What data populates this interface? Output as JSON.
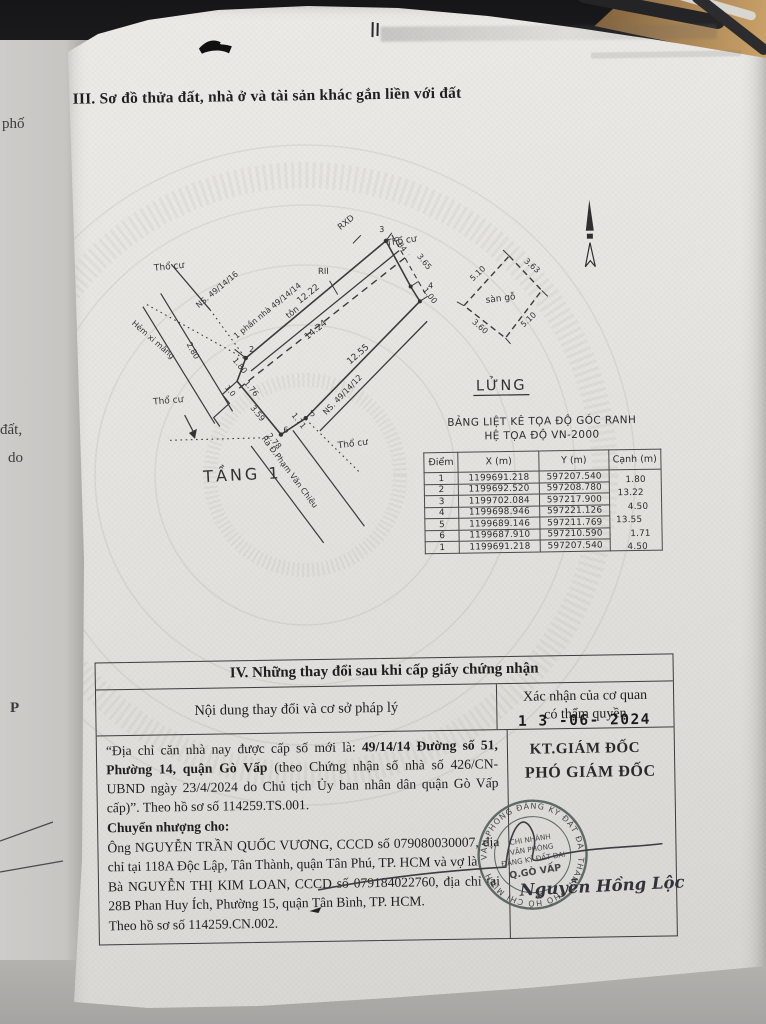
{
  "section3": {
    "title": "III. Sơ đồ thửa đất, nhà ở và tài sản khác gắn liền với đất"
  },
  "edge_fragments": {
    "f1": "phố",
    "f2": "đất,",
    "f3": "do",
    "f4": "P"
  },
  "diagram": {
    "floor_caption": "TẦNG 1",
    "mezz_caption": "LỬNG",
    "mezz_floor": "sàn gỗ",
    "tho_cu": "Thổ cư",
    "alley": "Hẻm xi măng",
    "neighbor_left": "NS. 49/14/16",
    "neighbor_right": "NS. 49/14/12",
    "house_part": "1 phần nhà 49/14/14",
    "street": "Ra Đ.Phạm Văn Chiêu",
    "roof": "tôn",
    "rxd": "RXD",
    "rii": "RII",
    "m": {
      "top": "12.22",
      "mid": "14.24",
      "bottom": "12.55",
      "r1": "3.65",
      "r2": "1.00",
      "r3": "0.84",
      "s180": "1.80",
      "s280": "2.80",
      "s10": "1.0",
      "s176": "1.76",
      "s359": "3.59",
      "s278": "2.78",
      "s171": "1.71"
    },
    "pts": {
      "p2": "2",
      "p3": "3",
      "p4": "4",
      "p5": "5",
      "p6": "6"
    },
    "mezz_m": {
      "top": "3.63",
      "left": "5.10",
      "right": "5.10",
      "bottom": "3.60"
    }
  },
  "coord_table": {
    "title1": "BẢNG LIỆT KÊ TỌA ĐỘ GÓC RANH",
    "title2": "HỆ TỌA ĐỘ VN-2000",
    "headers": [
      "Điểm",
      "X (m)",
      "Y (m)",
      "Cạnh (m)"
    ],
    "rows": [
      [
        "1",
        "1199691.218",
        "597207.540"
      ],
      [
        "2",
        "1199692.520",
        "597208.780"
      ],
      [
        "3",
        "1199702.084",
        "597217.900"
      ],
      [
        "4",
        "1199698.946",
        "597221.126"
      ],
      [
        "5",
        "1199689.146",
        "597211.769"
      ],
      [
        "6",
        "1199687.910",
        "597210.590"
      ],
      [
        "1",
        "1199691.218",
        "597207.540"
      ]
    ],
    "edges": [
      "1.80",
      "13.22",
      "4.50",
      "13.55",
      "1.71",
      "4.50"
    ]
  },
  "section4": {
    "title": "IV. Những thay đổi sau khi cấp giấy chứng nhận",
    "col1": "Nội dung thay đổi và cơ sở pháp lý",
    "col2a": "Xác nhận của cơ quan",
    "col2b": "có thẩm quyền",
    "p1a": "“Địa chỉ căn nhà nay được cấp số mới là: ",
    "p1b": "49/14/14 Đường số 51, Phường 14, quận Gò Vấp",
    "p1c": " (theo Chứng nhận số nhà số 426/CN-UBND ngày 23/4/2024 do Chủ tịch Ủy ban nhân dân quận Gò Vấp cấp)”. Theo hồ sơ số 114259.TS.001.",
    "p2": "Chuyển nhượng cho:",
    "p3": "Ông NGUYỄN TRẦN QUỐC VƯƠNG, CCCD số 079080030007, địa chỉ tại 118A Độc Lập, Tân Thành, quận Tân Phú, TP. HCM và vợ là",
    "p4": "Bà NGUYỄN THỊ KIM LOAN, CCCD số 079184022760, địa chỉ tại 28B Phan Huy Ích, Phường 15, quận Tân Bình, TP. HCM.",
    "p5": "Theo hồ sơ số 114259.CN.002.",
    "date_stamp": "1 3 -06- 2024",
    "kt": "KT.GIÁM ĐỐC",
    "pho": "PHÓ GIÁM ĐỐC",
    "signature": "Nguyễn Hồng Lộc",
    "stamp": {
      "ring": "VĂN PHÒNG ĐĂNG KÝ ĐẤT ĐAI THÀNH PHỐ HỒ CHÍ MINH",
      "l1": "CHI NHÁNH",
      "l2": "VĂN PHÒNG",
      "l3": "ĐĂNG KÝ ĐẤT ĐAI",
      "l4": "Q.GÒ VẤP",
      "star": "★"
    }
  },
  "colors": {
    "stamp": "#4e5b55",
    "ink": "#222222",
    "paper": "#e6e5e1"
  }
}
